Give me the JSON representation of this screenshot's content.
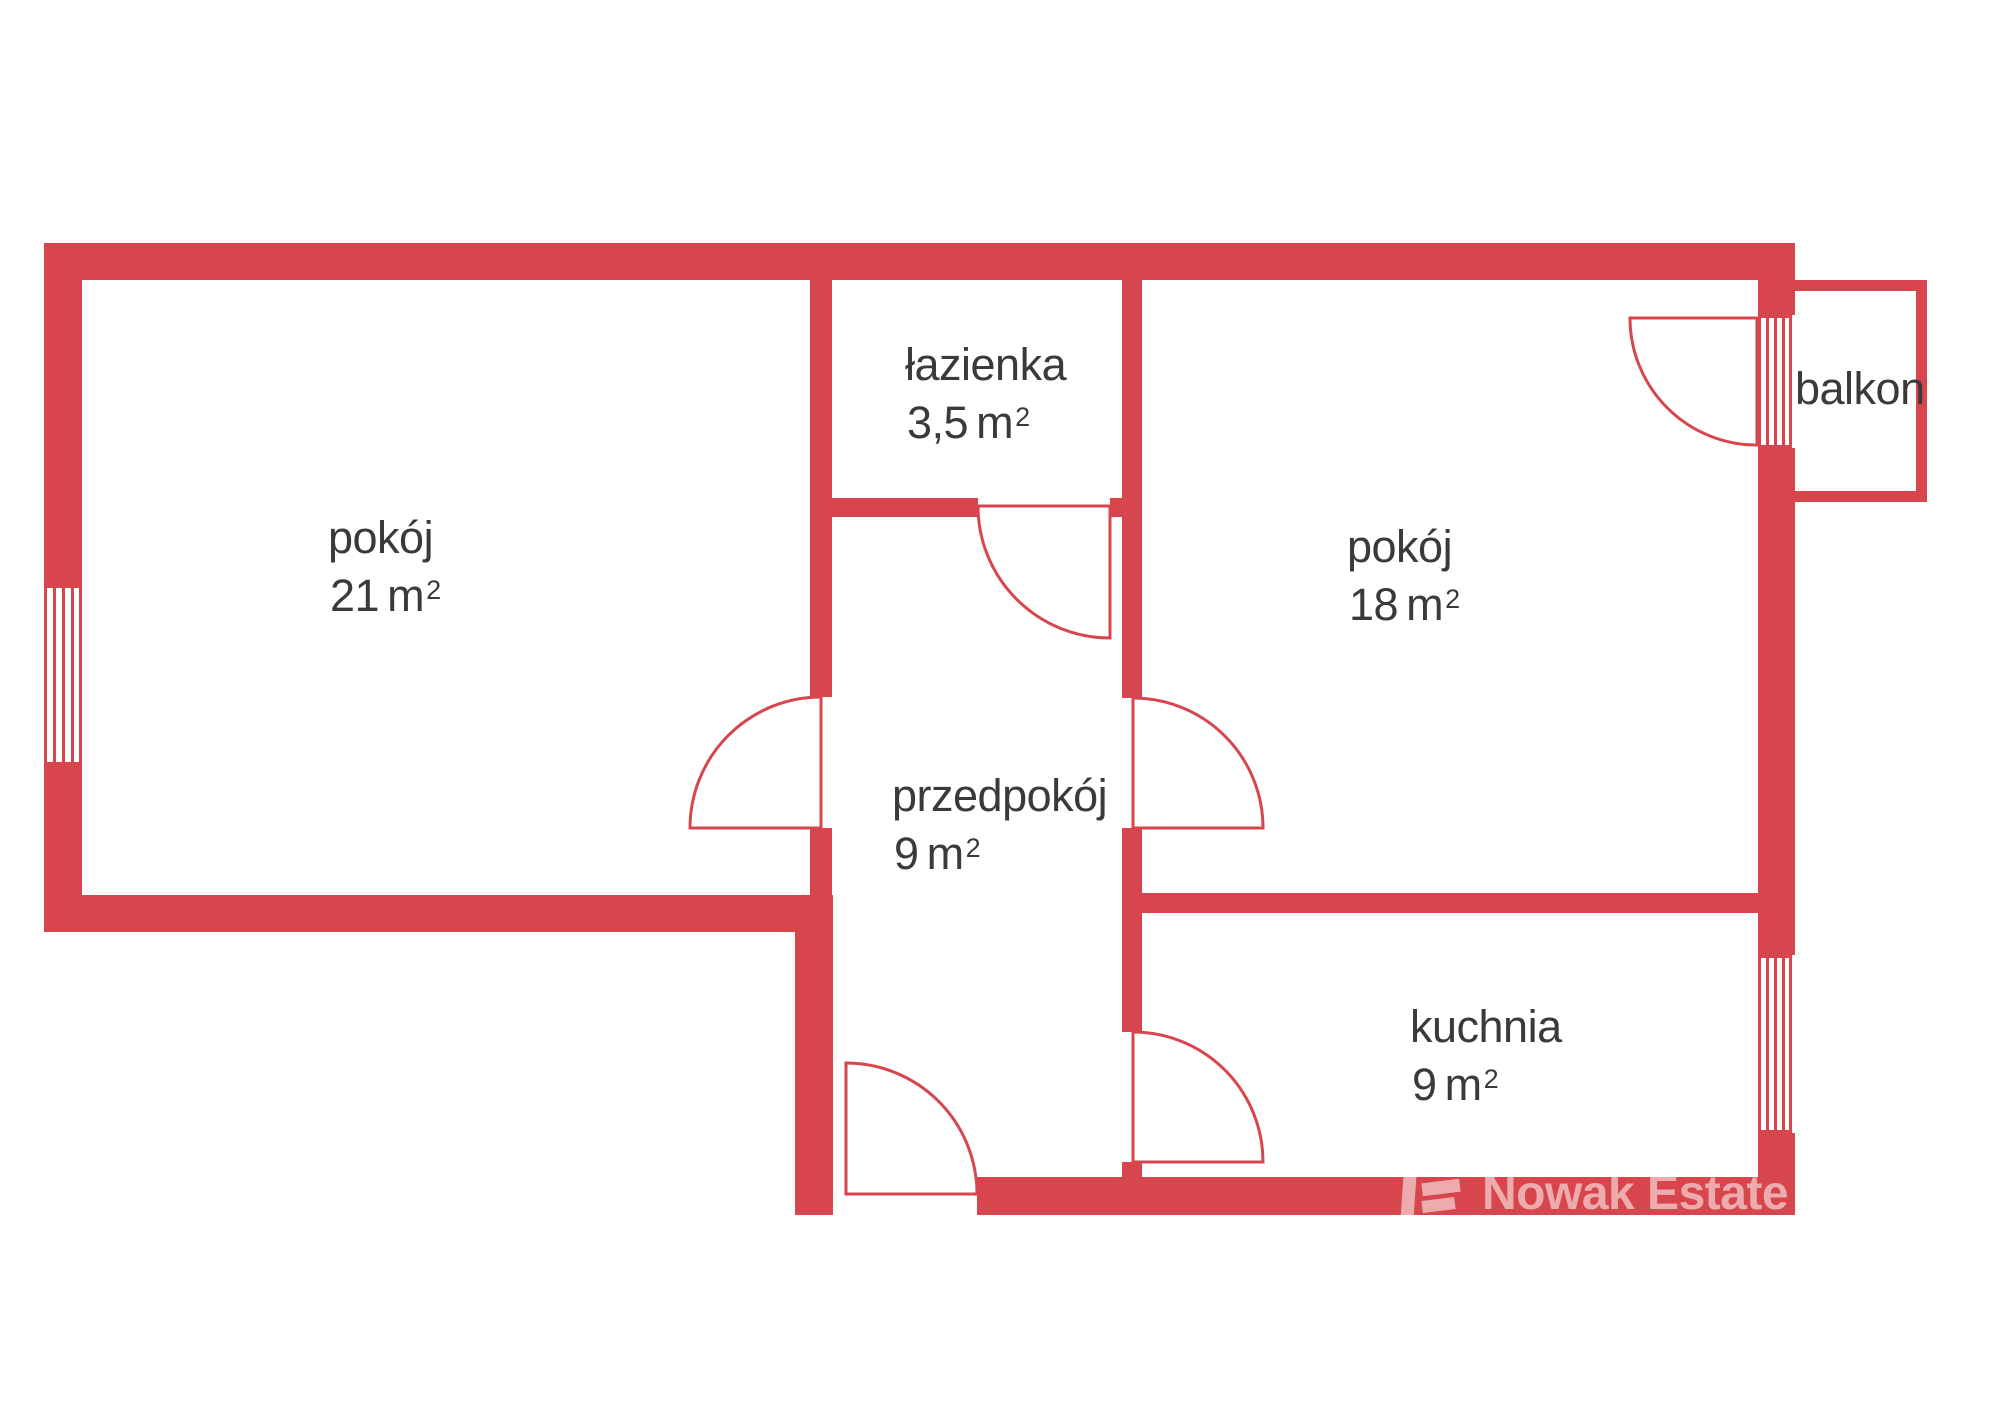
{
  "colors": {
    "wall": "#d7464d",
    "ink": "#3a3a3a",
    "wm": "rgba(255,255,255,0.55)"
  },
  "rooms": [
    {
      "name": "pokój",
      "area": "21",
      "unit": "m",
      "sup": "2"
    },
    {
      "name": "łazienka",
      "area": "3,5",
      "unit": "m",
      "sup": "2"
    },
    {
      "name": "pokój",
      "area": "18",
      "unit": "m",
      "sup": "2"
    },
    {
      "name": "przedpokój",
      "area": "9",
      "unit": "m",
      "sup": "2"
    },
    {
      "name": "kuchnia",
      "area": "9",
      "unit": "m",
      "sup": "2"
    },
    {
      "name": "balkon"
    }
  ],
  "watermark": {
    "text": "Nowak Estate"
  }
}
